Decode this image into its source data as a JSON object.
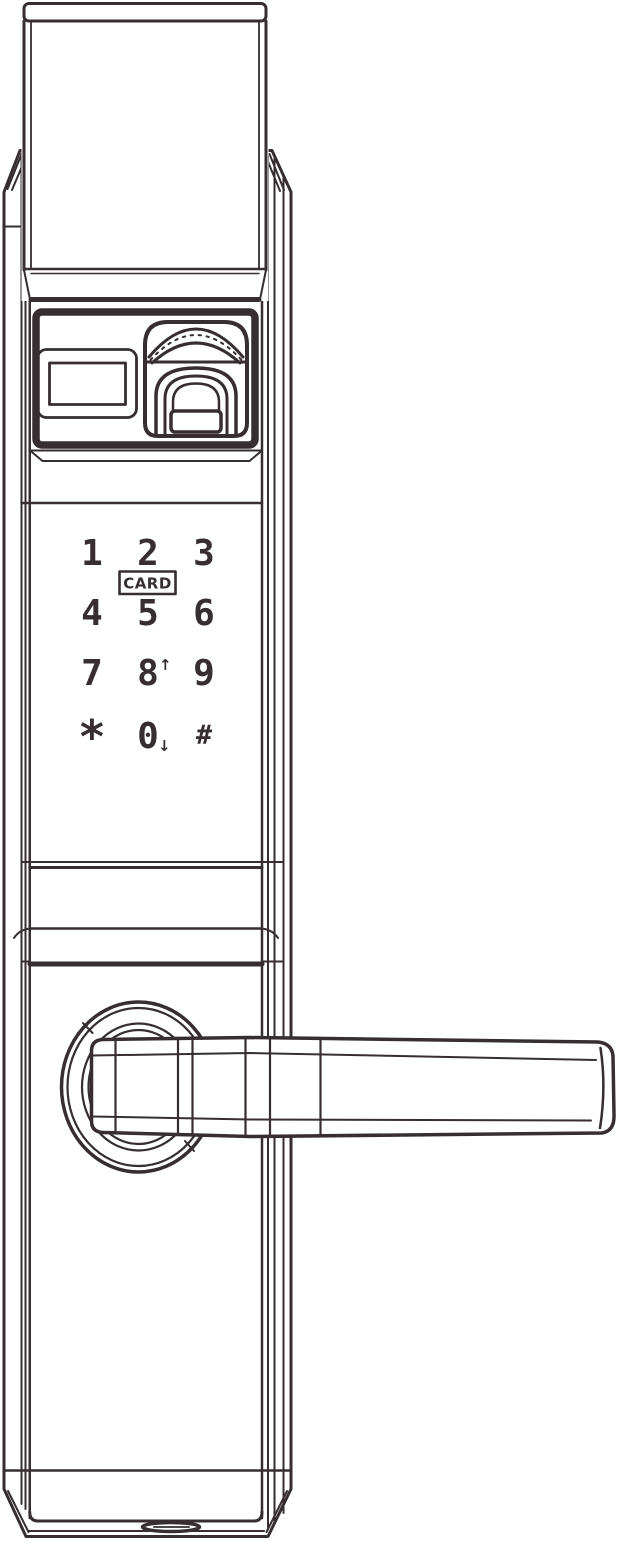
{
  "drawing": {
    "subject": "smart door lock front view technical line drawing",
    "line_color": "#362e30",
    "background_color": "#ffffff"
  },
  "keypad": {
    "keys": [
      "1",
      "2",
      "3",
      "4",
      "5",
      "6",
      "7",
      "8",
      "9",
      "*",
      "0",
      "#"
    ],
    "key_modifiers": {
      "8": "↑",
      "0": "↓"
    },
    "card_label": "CARD"
  }
}
